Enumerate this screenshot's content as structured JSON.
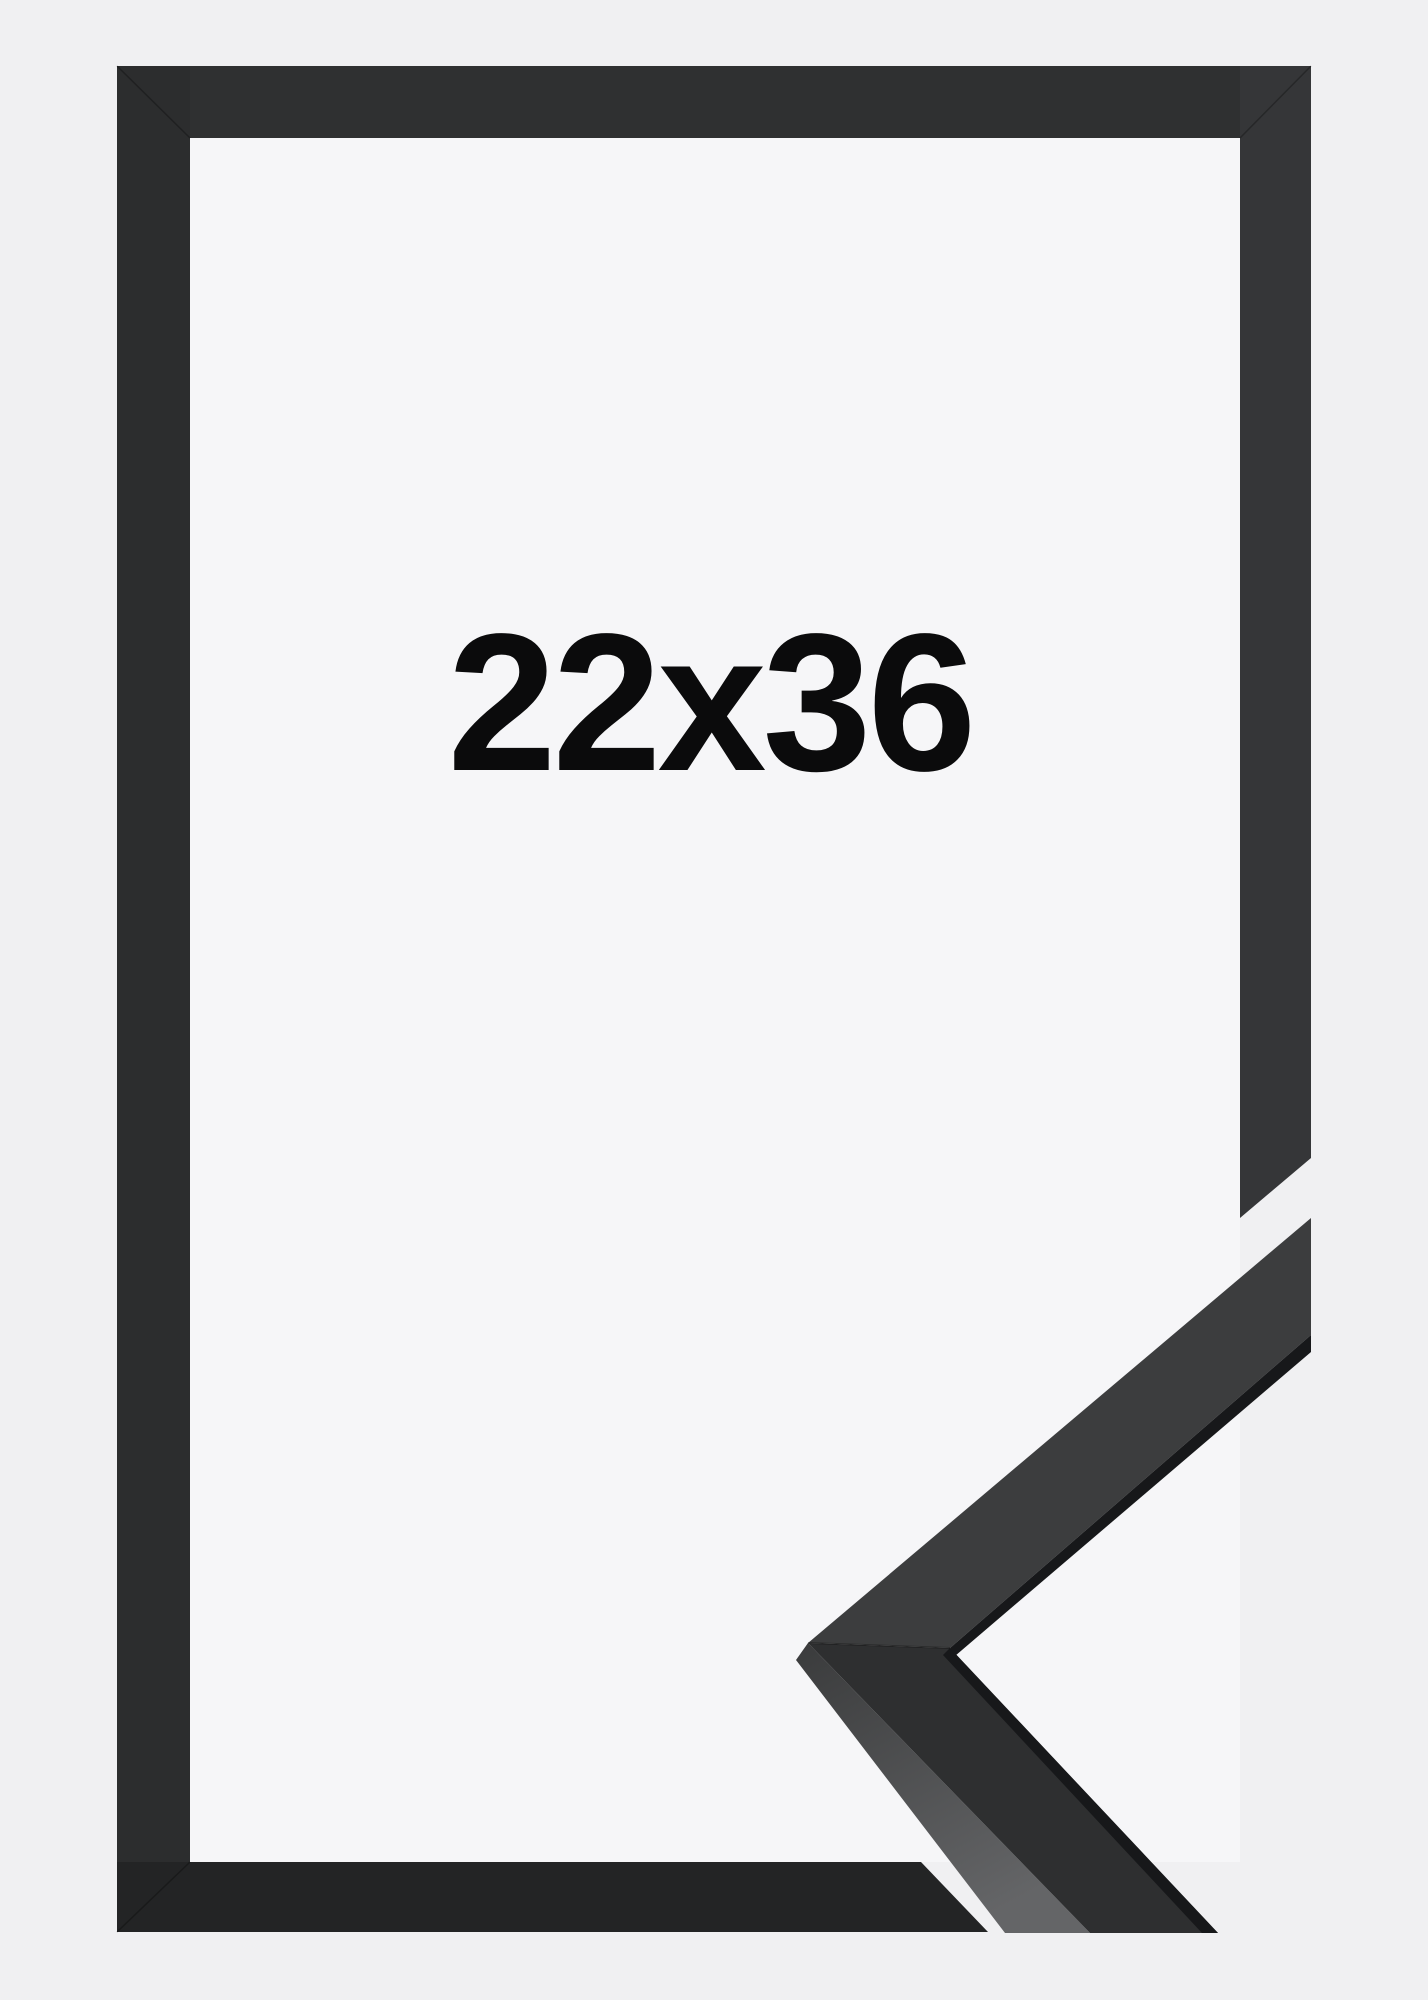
{
  "frame": {
    "size_label": "22x36",
    "colors": {
      "background": "#f0f0f2",
      "opening": "#f6f6f8",
      "border_top": "#2f3031",
      "border_left": "#2c2d2e",
      "border_right": "#353638",
      "border_bottom": "#232425",
      "sample_upper_face": "#3c3d3e",
      "sample_lower_face": "#2e2f30",
      "sample_lip": "#17181a",
      "sample_side_top": "#3a3b3c",
      "sample_side_bottom": "#646567",
      "seam": "rgba(0,0,0,0.28)",
      "label_text": "#0b0b0c"
    }
  }
}
